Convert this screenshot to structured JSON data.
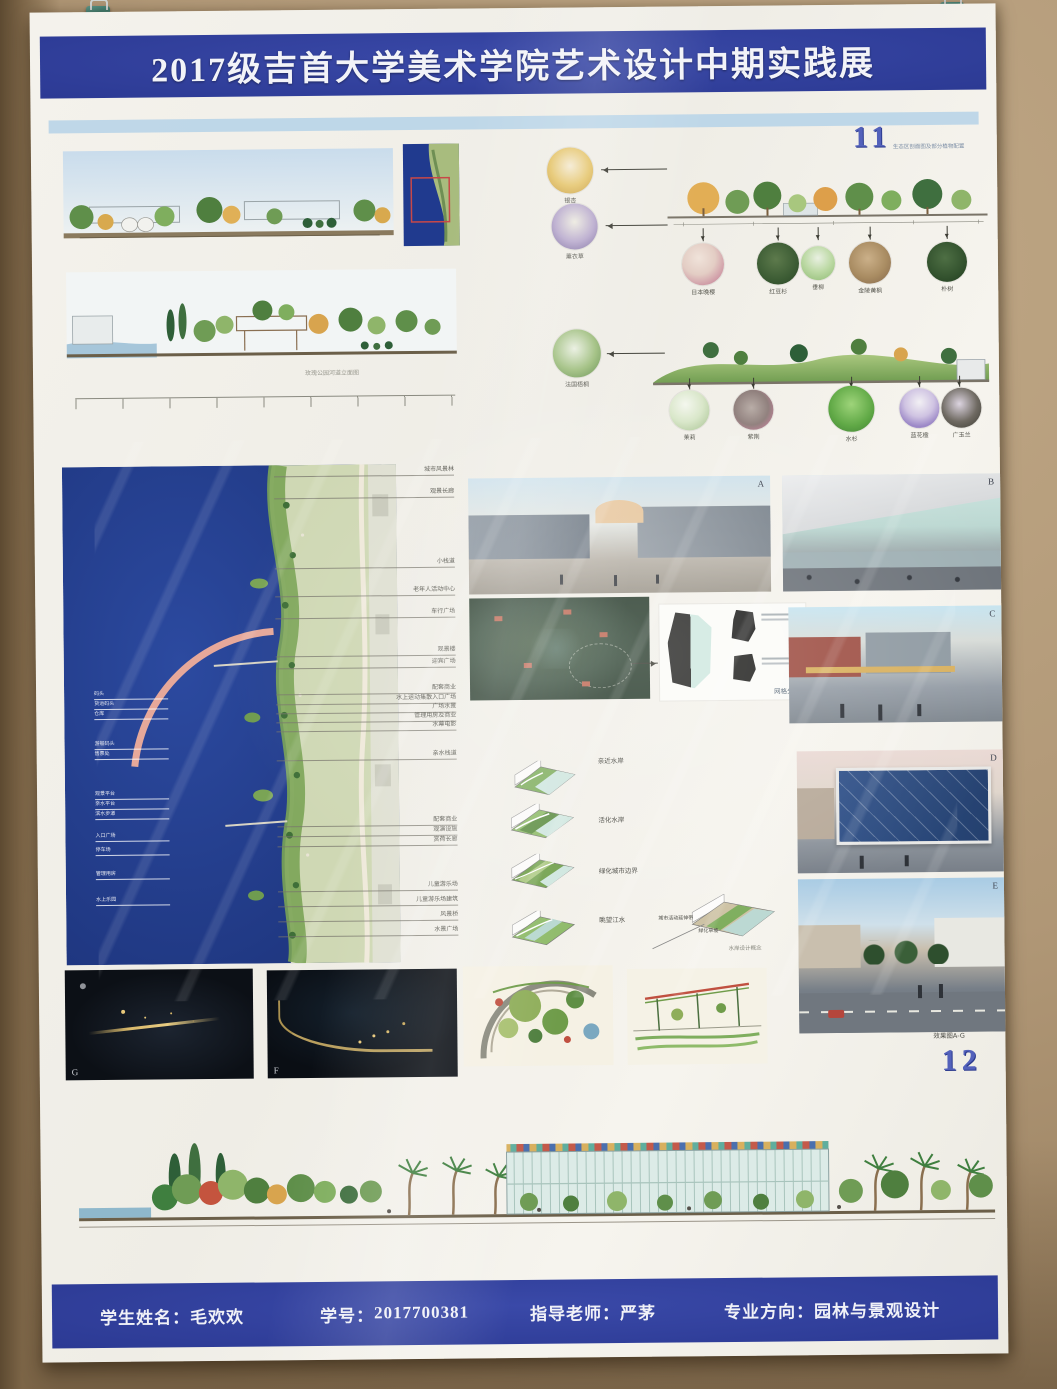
{
  "header": {
    "title": "2017级吉首大学美术学院艺术设计中期实践展"
  },
  "pages": {
    "p11": "11",
    "p11_caption": "生态区剖面图及部分植物配置",
    "p12": "12",
    "p12_caption": "效果图A-G"
  },
  "captions": {
    "rose_park": "玫瑰公园河道立面图",
    "grid_analysis": "网格分析",
    "concept": "水岸设计概念"
  },
  "planting": {
    "side": [
      "银杏",
      "薰衣草",
      "法国梧桐"
    ],
    "row1": [
      "日本晚樱",
      "红豆杉",
      "垂柳",
      "金陵黄枫",
      "朴树"
    ],
    "row2": [
      "茉莉",
      "紫荆",
      "水杉",
      "蓝花楹",
      "广玉兰"
    ]
  },
  "plan": {
    "right_labels": [
      "城市风景林",
      "观景长廊",
      "小栈道",
      "老年人活动中心",
      "车行广场",
      "观景楼",
      "迎宾广场",
      "配套商业",
      "水上运动集散入口广场",
      "广场水景",
      "管理用房及商业",
      "水幕电影",
      "亲水栈道",
      "配套商业",
      "观演设施",
      "赏荷长廊",
      "儿童游乐场",
      "儿童游乐场建筑",
      "风景桥",
      "水景广场"
    ],
    "left_labels": [
      "码头",
      "货运码头",
      "仓库",
      "游船码头",
      "售票处",
      "观景平台",
      "亲水平台",
      "滨水步道",
      "入口广场",
      "停车场",
      "管理用房",
      "水上乐园"
    ]
  },
  "diagrams": {
    "top": "亲近水岸",
    "l1": "活化水岸",
    "l2": "绿化城市边界",
    "l3": "眺望江水",
    "c1": "城市活动延伸带",
    "c2": "绿化草坡"
  },
  "renders": {
    "a": "A",
    "b": "B",
    "c": "C",
    "d": "D",
    "e": "E",
    "f": "F",
    "g": "G"
  },
  "footer": {
    "name_label": "学生姓名：",
    "name_value": "毛欢欢",
    "id_label": "学号：",
    "id_value": "2017700381",
    "teacher_label": "指导老师：",
    "teacher_value": "严茅",
    "major_label": "专业方向：",
    "major_value": "园林与景观设计"
  },
  "colors": {
    "banner_blue": "#2c3a94",
    "page_number_blue": "#5361bb",
    "wall_tan": "#b09776",
    "water_blue": "#27418f",
    "marker_red": "#c84848"
  }
}
